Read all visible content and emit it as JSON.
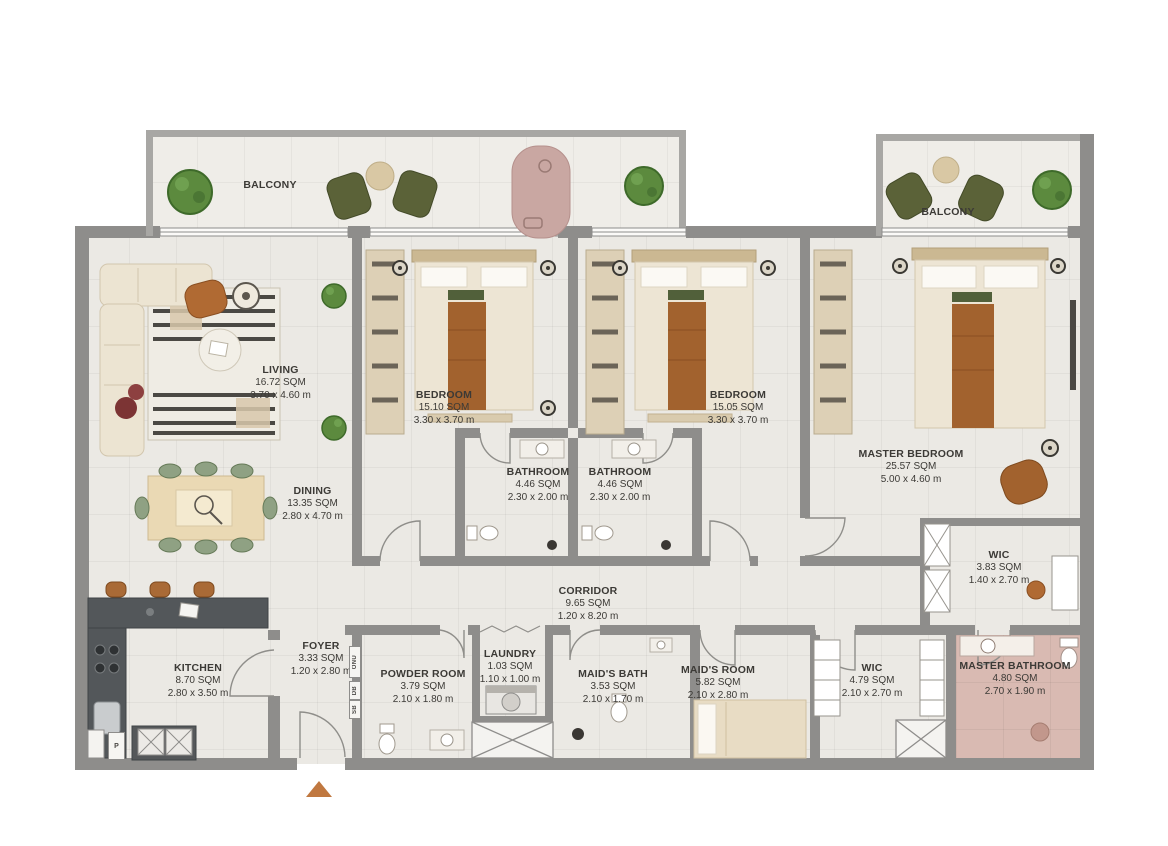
{
  "plan_title": "3 Bedroom + Maid Apartment Floor Plan",
  "rooms": {
    "living": {
      "name": "LIVING",
      "area": "16.72 SQM",
      "dims": "3.70 x 4.60 m"
    },
    "dining": {
      "name": "DINING",
      "area": "13.35 SQM",
      "dims": "2.80 x 4.70 m"
    },
    "bedroom1": {
      "name": "BEDROOM",
      "area": "15.10 SQM",
      "dims": "3.30 x 3.70 m"
    },
    "bedroom2": {
      "name": "BEDROOM",
      "area": "15.05 SQM",
      "dims": "3.30 x 3.70 m"
    },
    "master_bedroom": {
      "name": "MASTER BEDROOM",
      "area": "25.57 SQM",
      "dims": "5.00 x 4.60 m"
    },
    "bathroom1": {
      "name": "BATHROOM",
      "area": "4.46 SQM",
      "dims": "2.30 x 2.00 m"
    },
    "bathroom2": {
      "name": "BATHROOM",
      "area": "4.46 SQM",
      "dims": "2.30 x 2.00 m"
    },
    "corridor": {
      "name": "CORRIDOR",
      "area": "9.65 SQM",
      "dims": "1.20 x 8.20 m"
    },
    "kitchen": {
      "name": "KITCHEN",
      "area": "8.70 SQM",
      "dims": "2.80 x 3.50 m"
    },
    "foyer": {
      "name": "FOYER",
      "area": "3.33 SQM",
      "dims": "1.20 x 2.80 m"
    },
    "powder_room": {
      "name": "POWDER ROOM",
      "area": "3.79 SQM",
      "dims": "2.10 x 1.80 m"
    },
    "laundry": {
      "name": "LAUNDRY",
      "area": "1.03 SQM",
      "dims": "1.10 x 1.00 m"
    },
    "maids_bath": {
      "name": "MAID'S BATH",
      "area": "3.53 SQM",
      "dims": "2.10 x 1.70 m"
    },
    "maids_room": {
      "name": "MAID'S ROOM",
      "area": "5.82 SQM",
      "dims": "2.10 x 2.80 m"
    },
    "wic_corridor": {
      "name": "WIC",
      "area": "4.79 SQM",
      "dims": "2.10 x 2.70 m"
    },
    "wic_master": {
      "name": "WIC",
      "area": "3.83 SQM",
      "dims": "1.40 x 2.70 m"
    },
    "master_bathroom": {
      "name": "MASTER BATHROOM",
      "area": "4.80 SQM",
      "dims": "2.70 x 1.90 m"
    },
    "balcony_left": {
      "name": "BALCONY"
    },
    "balcony_right": {
      "name": "BALCONY"
    }
  },
  "labels": {
    "onu": "ONU",
    "db": "DB",
    "sb": "SB",
    "pantry": "P"
  },
  "colors": {
    "wall": "#8e8d8b",
    "balcony_wall": "#a8a7a4",
    "floor": "#ebe9e4",
    "master_bath_floor": "#d9bab2",
    "wood_accent": "#a2622e",
    "armchair": "#b06a33",
    "olive_chair": "#5b6238",
    "sage_chair": "#8fa183",
    "plant_green": "#5c8a3e",
    "daybed_pink": "#c9a7a2",
    "counter_dark": "#53575a",
    "entry_arrow": "#c07840",
    "bed_cream": "#ede5d4",
    "closet_tan": "#ddd0b6"
  }
}
